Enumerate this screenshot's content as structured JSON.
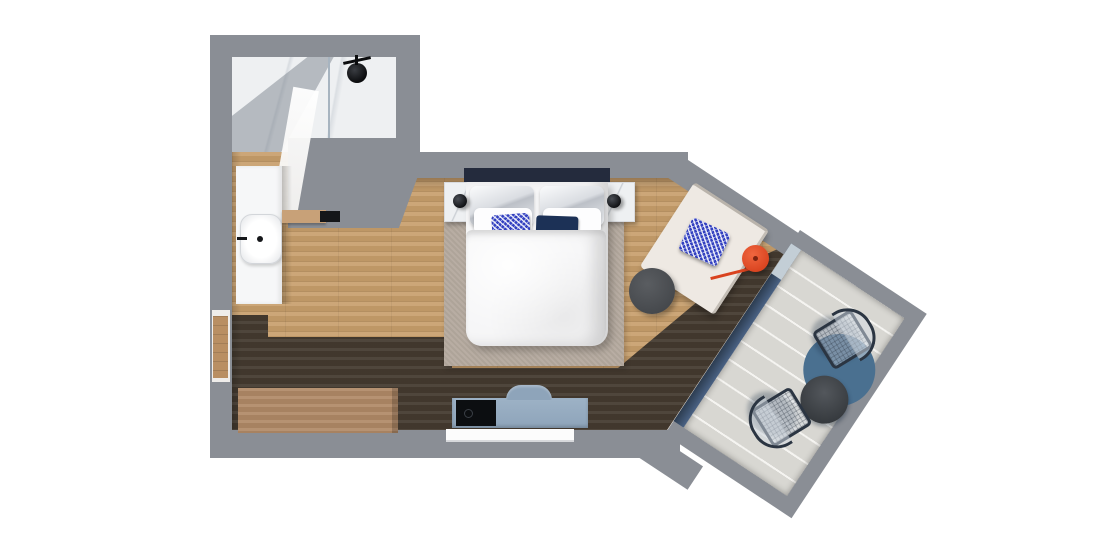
{
  "scene": {
    "description": "Top-down 3D rendered floor plan of a hotel studio room with bathroom, bedroom and angled balcony",
    "view": "top-down render",
    "rooms": [
      {
        "name": "bathroom",
        "features": [
          "walk-in shower",
          "rain shower head",
          "glass partition",
          "marble floor"
        ]
      },
      {
        "name": "vanity corridor",
        "features": [
          "white counter",
          "washbasin",
          "black faucet",
          "wall shelf",
          "entry door"
        ]
      },
      {
        "name": "bedroom",
        "features": [
          "oak plank floor",
          "dark wood floor zone",
          "taupe area rug",
          "double bed",
          "white duvet",
          "silver pillows",
          "blue patterned pillow",
          "navy pillow",
          "marble nightstands",
          "black bedside lamps",
          "wardrobe",
          "window desk",
          "desk chair",
          "black desk object",
          "window sill",
          "chaise lounge",
          "gray ottoman",
          "red floor lamp"
        ]
      },
      {
        "name": "balcony",
        "features": [
          "plank decking",
          "glass sliding wall",
          "open door",
          "round blue rug",
          "dark bistro table",
          "two wire chairs"
        ]
      }
    ]
  },
  "palette": {
    "wall": "#8a8e95",
    "oak": "#c89f6c",
    "darkFloor": "#463c31",
    "marble": "#eef0f2",
    "marbleShadow": "rgba(124,131,141,0.5)",
    "glassLine": "#a7b4c0",
    "counter": "#f6f7f8",
    "shelfWood": "#c8a178",
    "doorWood": "#b98f63",
    "wardrobe": "#b18a67",
    "rugTaupe": "#b4a99e",
    "headboard": "#242b3d",
    "bedWhite": "#f6f6f7",
    "bluePillow": "#3240c0",
    "navyPillow": "#1c3156",
    "chaise": "#eee9e3",
    "ottoman": "#45484c",
    "red": "#d9431f",
    "desk": "#8ea4ba",
    "deskItem": "#0c0e11",
    "deck": "#d8d7d2",
    "deckLine": "#f5f4f1",
    "glassWall": "#4a6284",
    "rugBlue": "#4a7090",
    "tableDark": "#34383c",
    "chairFrame": "#2b3542"
  }
}
